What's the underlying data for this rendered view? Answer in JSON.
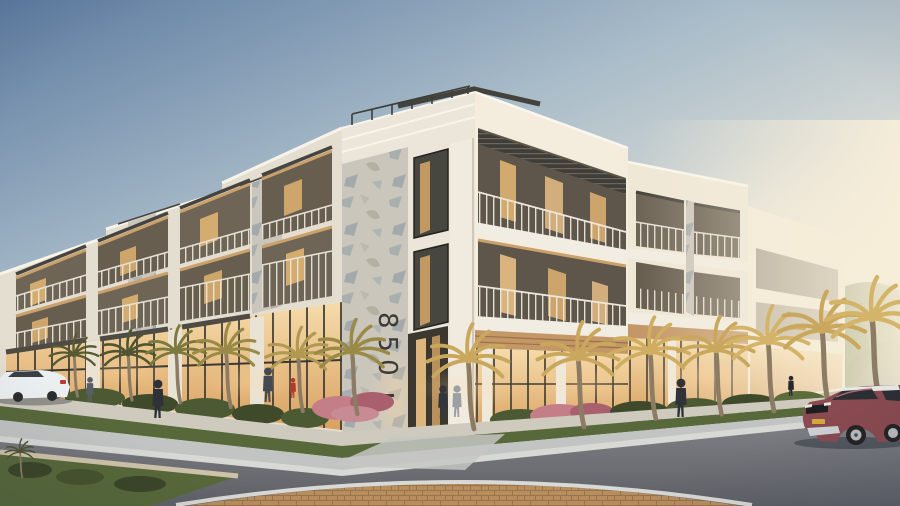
{
  "scene": {
    "type": "architectural rendering",
    "title": "Modern three-story mixed-use building at dusk with palm-lined street",
    "address_number": "850",
    "building": {
      "floors": 3,
      "facade": "white stucco with textured concrete piers, recessed balconies, dark-framed glazing",
      "ground_floor": "warm-lit glass storefronts with wood soffits"
    },
    "vehicles": {
      "right": "dark red compact SUV",
      "left": "white sedan (partially visible)"
    },
    "people_visible": 9,
    "landscape": "palm trees, hedges, pink flowering shrubs, grass median",
    "foreground": "curved asphalt road with brick paver apron"
  },
  "palette": {
    "sky_top": "#5d7ba0",
    "sky_mid": "#a9bcc9",
    "sky_low": "#e3e2d8",
    "sky_warm": "#f6ecd6",
    "wall_left_wing": "#e4ded1",
    "wall_tower_left": "#ece6da",
    "wall_tower_right": "#f4edde",
    "wall_right_wing": "#f0e8d7",
    "wall_far_wing": "#f4ecd9",
    "texture_base": "#cbc6bc",
    "recess_dark": "#6e6557",
    "soffit_wood": "#c49767",
    "glass_hi": "#f6dcab",
    "glass_lo": "#d9a160",
    "glass_dark": "#474740",
    "louver": "#3f3e39",
    "address_color": "#3b3a35",
    "road": "#7e8085",
    "road_dark": "#5e6066",
    "sidewalk": "#c2c4c3",
    "curb": "#d8d9d5",
    "apron": "#cfcabe",
    "paver": "#b98e5e",
    "grass": "#57683a",
    "lawn_light": "#93a058",
    "hedge": "#3f4a2b",
    "flower_pink": "#c47e88",
    "palm_gold": "#c9a85e",
    "palm_dark": "#565a31",
    "trunk": "#8d7c64",
    "tree_green": "#647247",
    "car_body": "#8a4a50",
    "car_roof": "#e9e9e7",
    "car_glass": "#2b2e33",
    "plate_yellow": "#d2a93c",
    "white_car": "#eceff0"
  }
}
